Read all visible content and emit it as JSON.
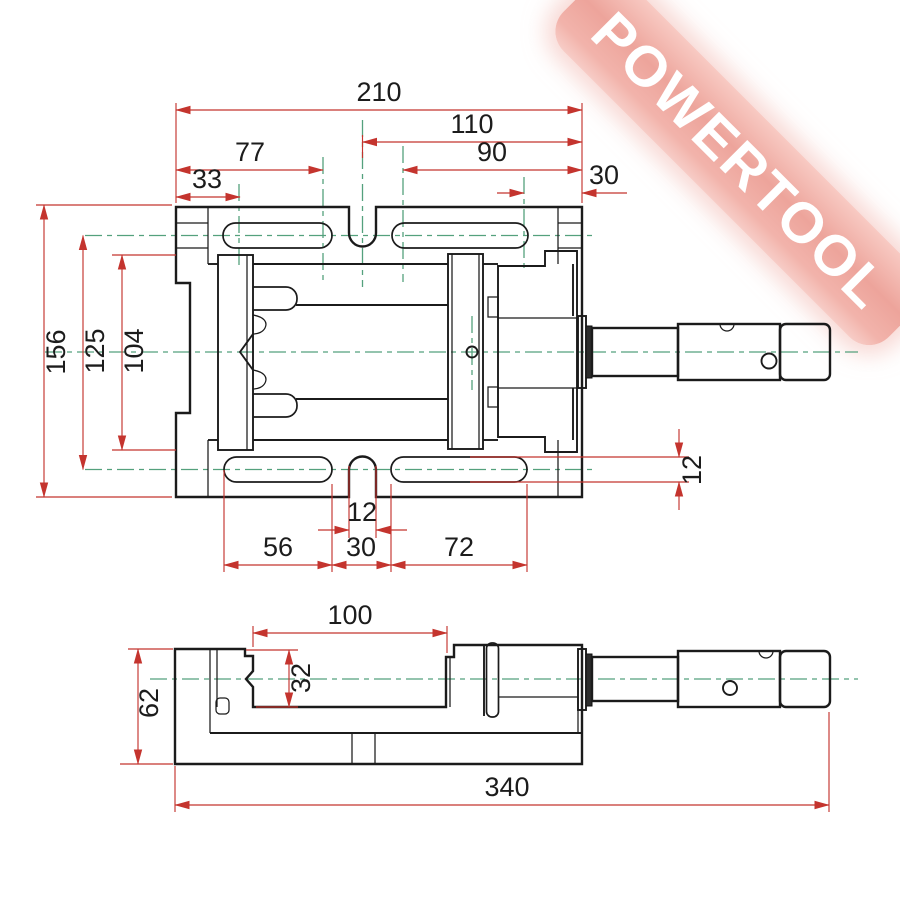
{
  "watermark": {
    "text": "POWERTOOL",
    "color": "#eda49b"
  },
  "colors": {
    "outline": "#1b1b1b",
    "dimension": "#c4342e",
    "centerline": "#54a17d"
  },
  "views": {
    "top": {
      "dims": {
        "overall_width": "210",
        "right_half": "110",
        "jaw_span": "77",
        "screw_span": "90",
        "left_inset": "33",
        "right_inset": "30",
        "overall_depth": "156",
        "slot_rows": "125",
        "jaw_plate": "104",
        "slot_height": "12",
        "key_notch": "12",
        "left_slot": "56",
        "slot_gap": "30",
        "right_slot": "72"
      }
    },
    "front": {
      "dims": {
        "jaw_opening": "100",
        "jaw_height": "32",
        "base_height": "62",
        "overall_length": "340"
      }
    }
  }
}
